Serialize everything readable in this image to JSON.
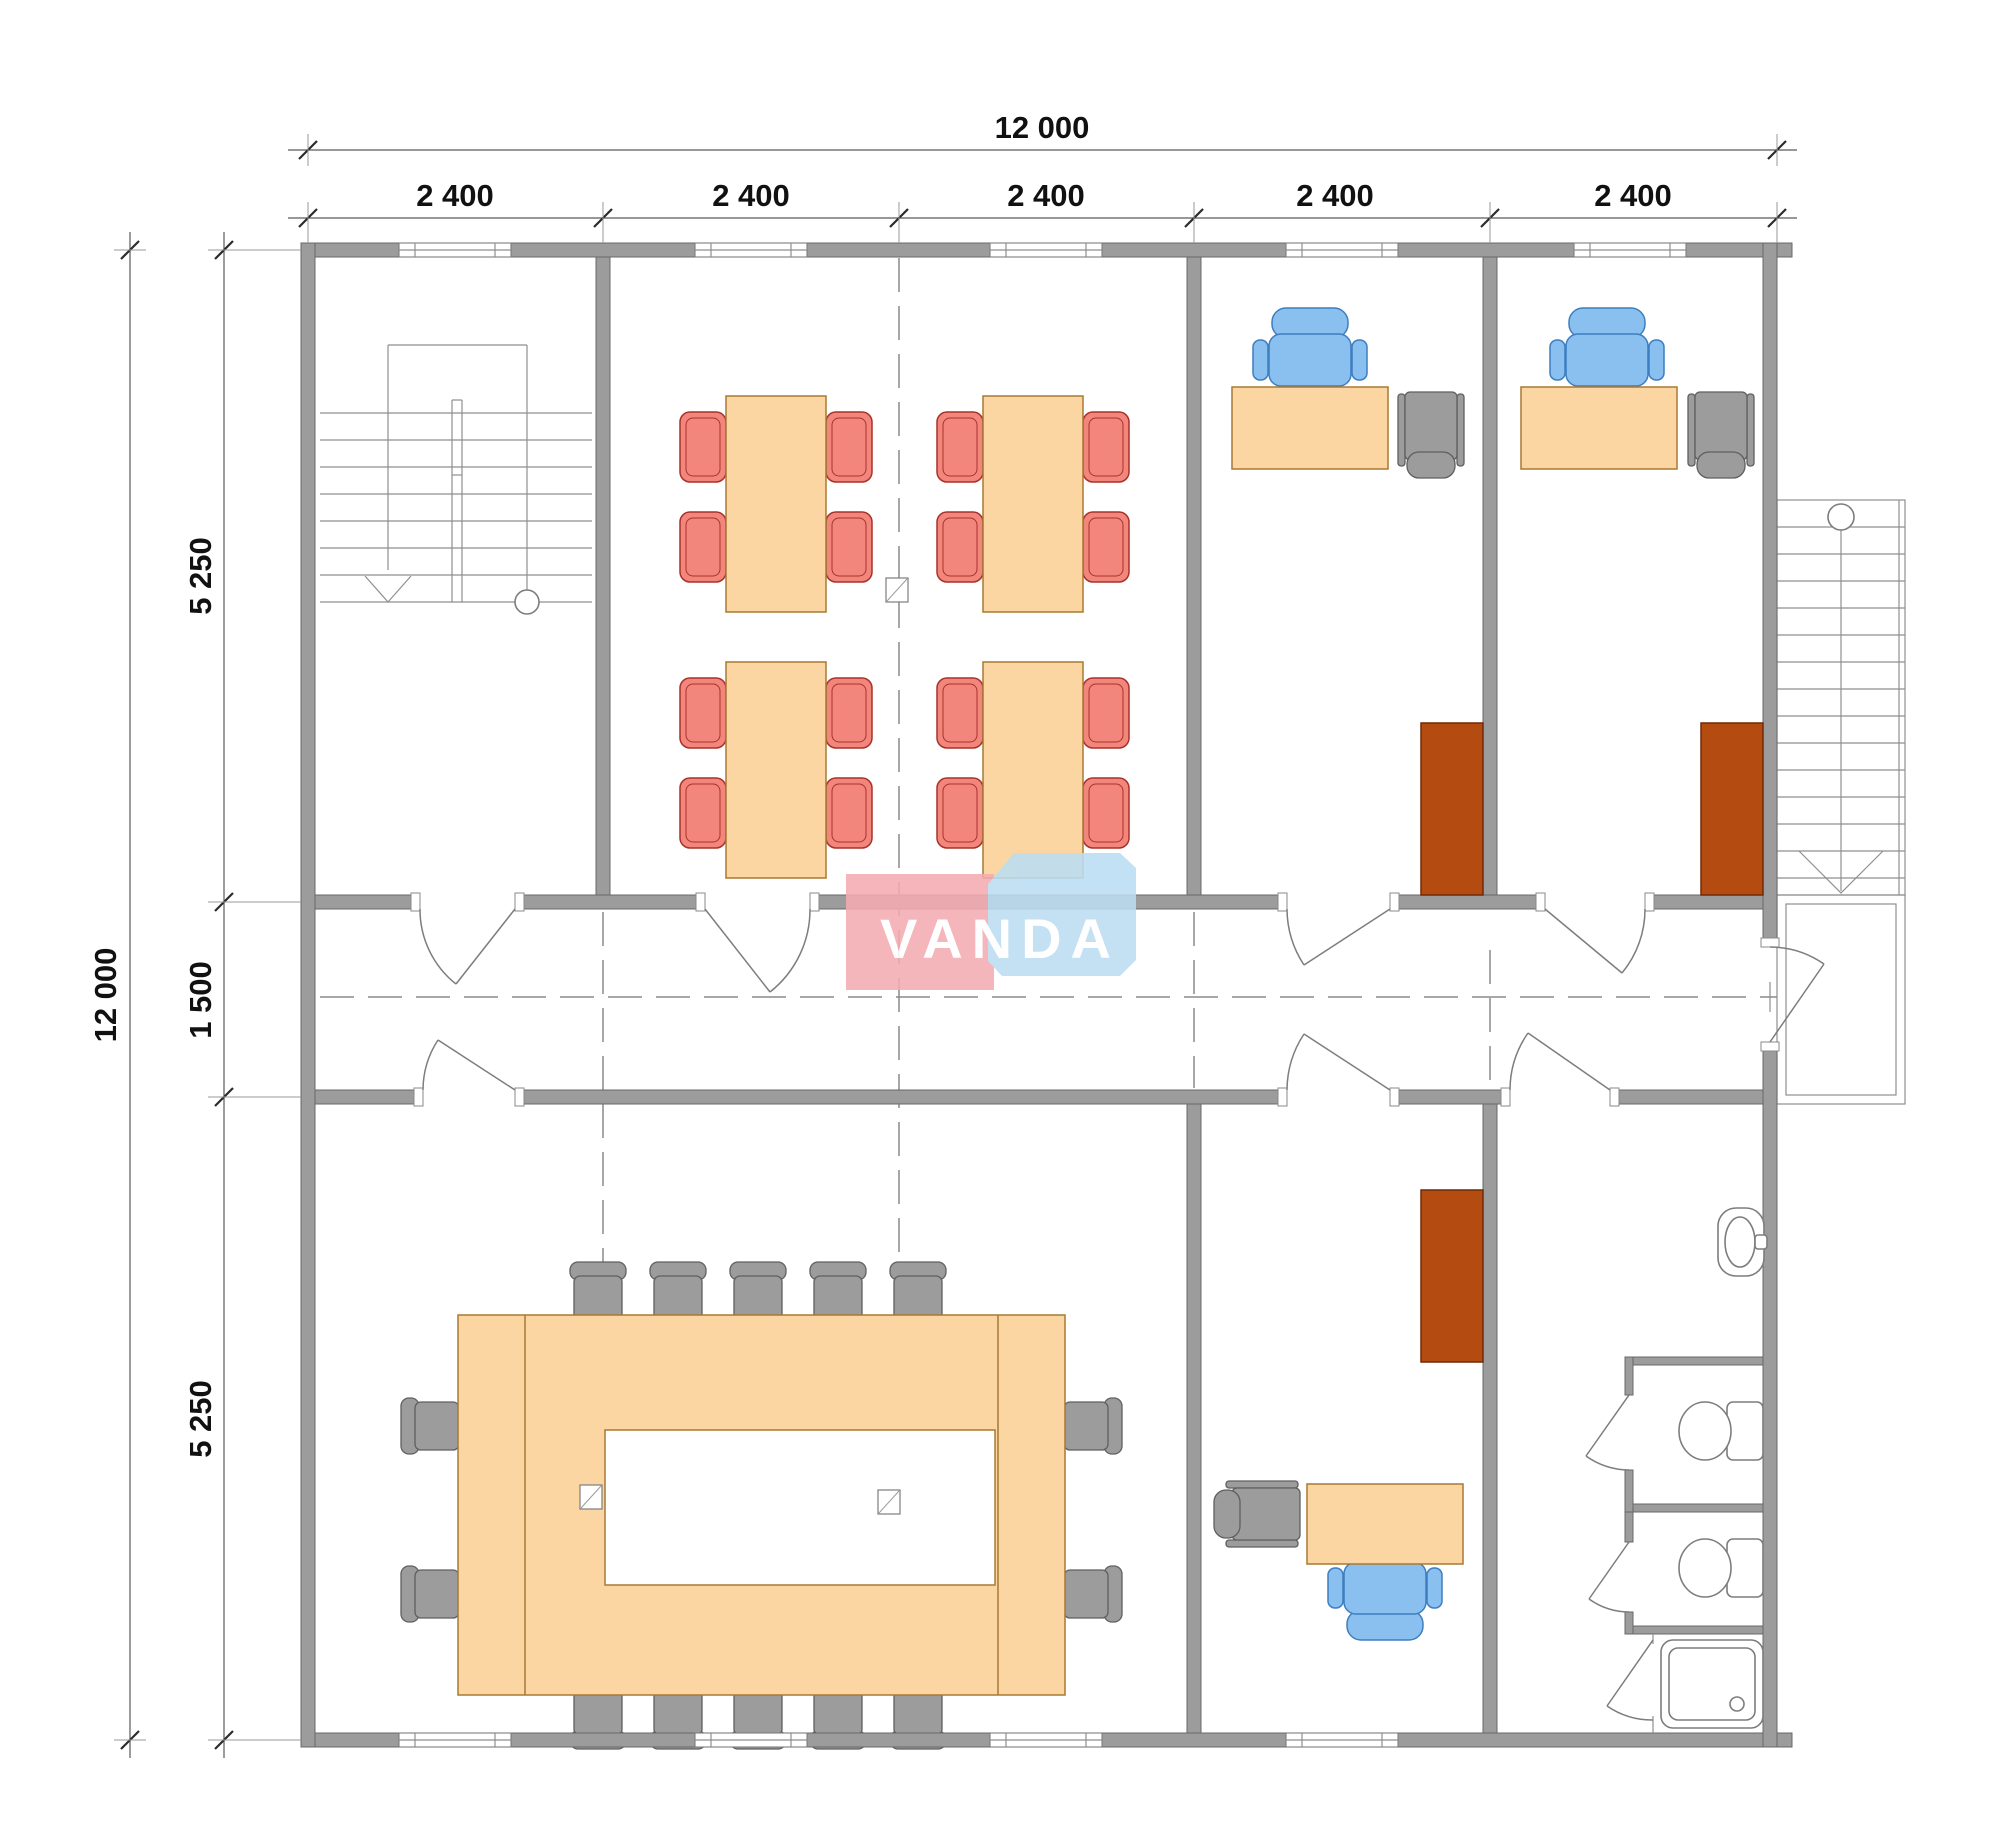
{
  "drawing": {
    "type": "architectural-floor-plan",
    "watermark": "VANDA"
  },
  "dimensions": {
    "top": {
      "overall": "12 000",
      "segments": [
        "2 400",
        "2 400",
        "2 400",
        "2 400",
        "2 400"
      ]
    },
    "left": {
      "overall": "12 000",
      "segments": [
        "5 250",
        "1 500",
        "5 250"
      ]
    }
  },
  "logo": {
    "text": "VANDA",
    "pink": "#F4ACB2",
    "blue": "#BBDDF2",
    "text_color": "#FFFFFF"
  },
  "colors": {
    "wall": "#9C9C9C",
    "table": "#FBD6A2",
    "chair_red": "#F2867C",
    "chair_blue": "#8AC0EF",
    "chair_gray": "#9C9C9C",
    "cabinet": "#B44B10",
    "line": "#7d7d7d",
    "background": "#FFFFFF"
  },
  "rooms": {
    "stairwell": {
      "features": [
        "internal-staircase",
        "down-arrow",
        "window"
      ]
    },
    "canteen": {
      "tables": 4,
      "chairs": 16,
      "chair_color": "red",
      "windows": 2,
      "column_markers": 1
    },
    "office_top_1": {
      "furniture": [
        "desk",
        "task-chair-blue",
        "visitor-chair-gray",
        "cabinet-brown"
      ],
      "windows": 1
    },
    "office_top_2": {
      "furniture": [
        "desk",
        "task-chair-blue",
        "visitor-chair-gray",
        "cabinet-brown"
      ],
      "windows": 1
    },
    "corridor": {
      "doors_opening_into": 7,
      "centerline": "dashed"
    },
    "conference_room": {
      "table": "ring",
      "chairs": 14,
      "column_markers": 2,
      "windows": 3
    },
    "office_bottom": {
      "furniture": [
        "desk",
        "task-chair-blue",
        "visitor-chair-gray",
        "cabinet-brown"
      ],
      "windows": 1
    },
    "washroom": {
      "fixtures": [
        "sink",
        "toilet",
        "toilet",
        "shower-tray"
      ],
      "stalls": 2
    },
    "external_stair": {
      "treads": 14,
      "landing": true,
      "exit_door": true
    }
  }
}
